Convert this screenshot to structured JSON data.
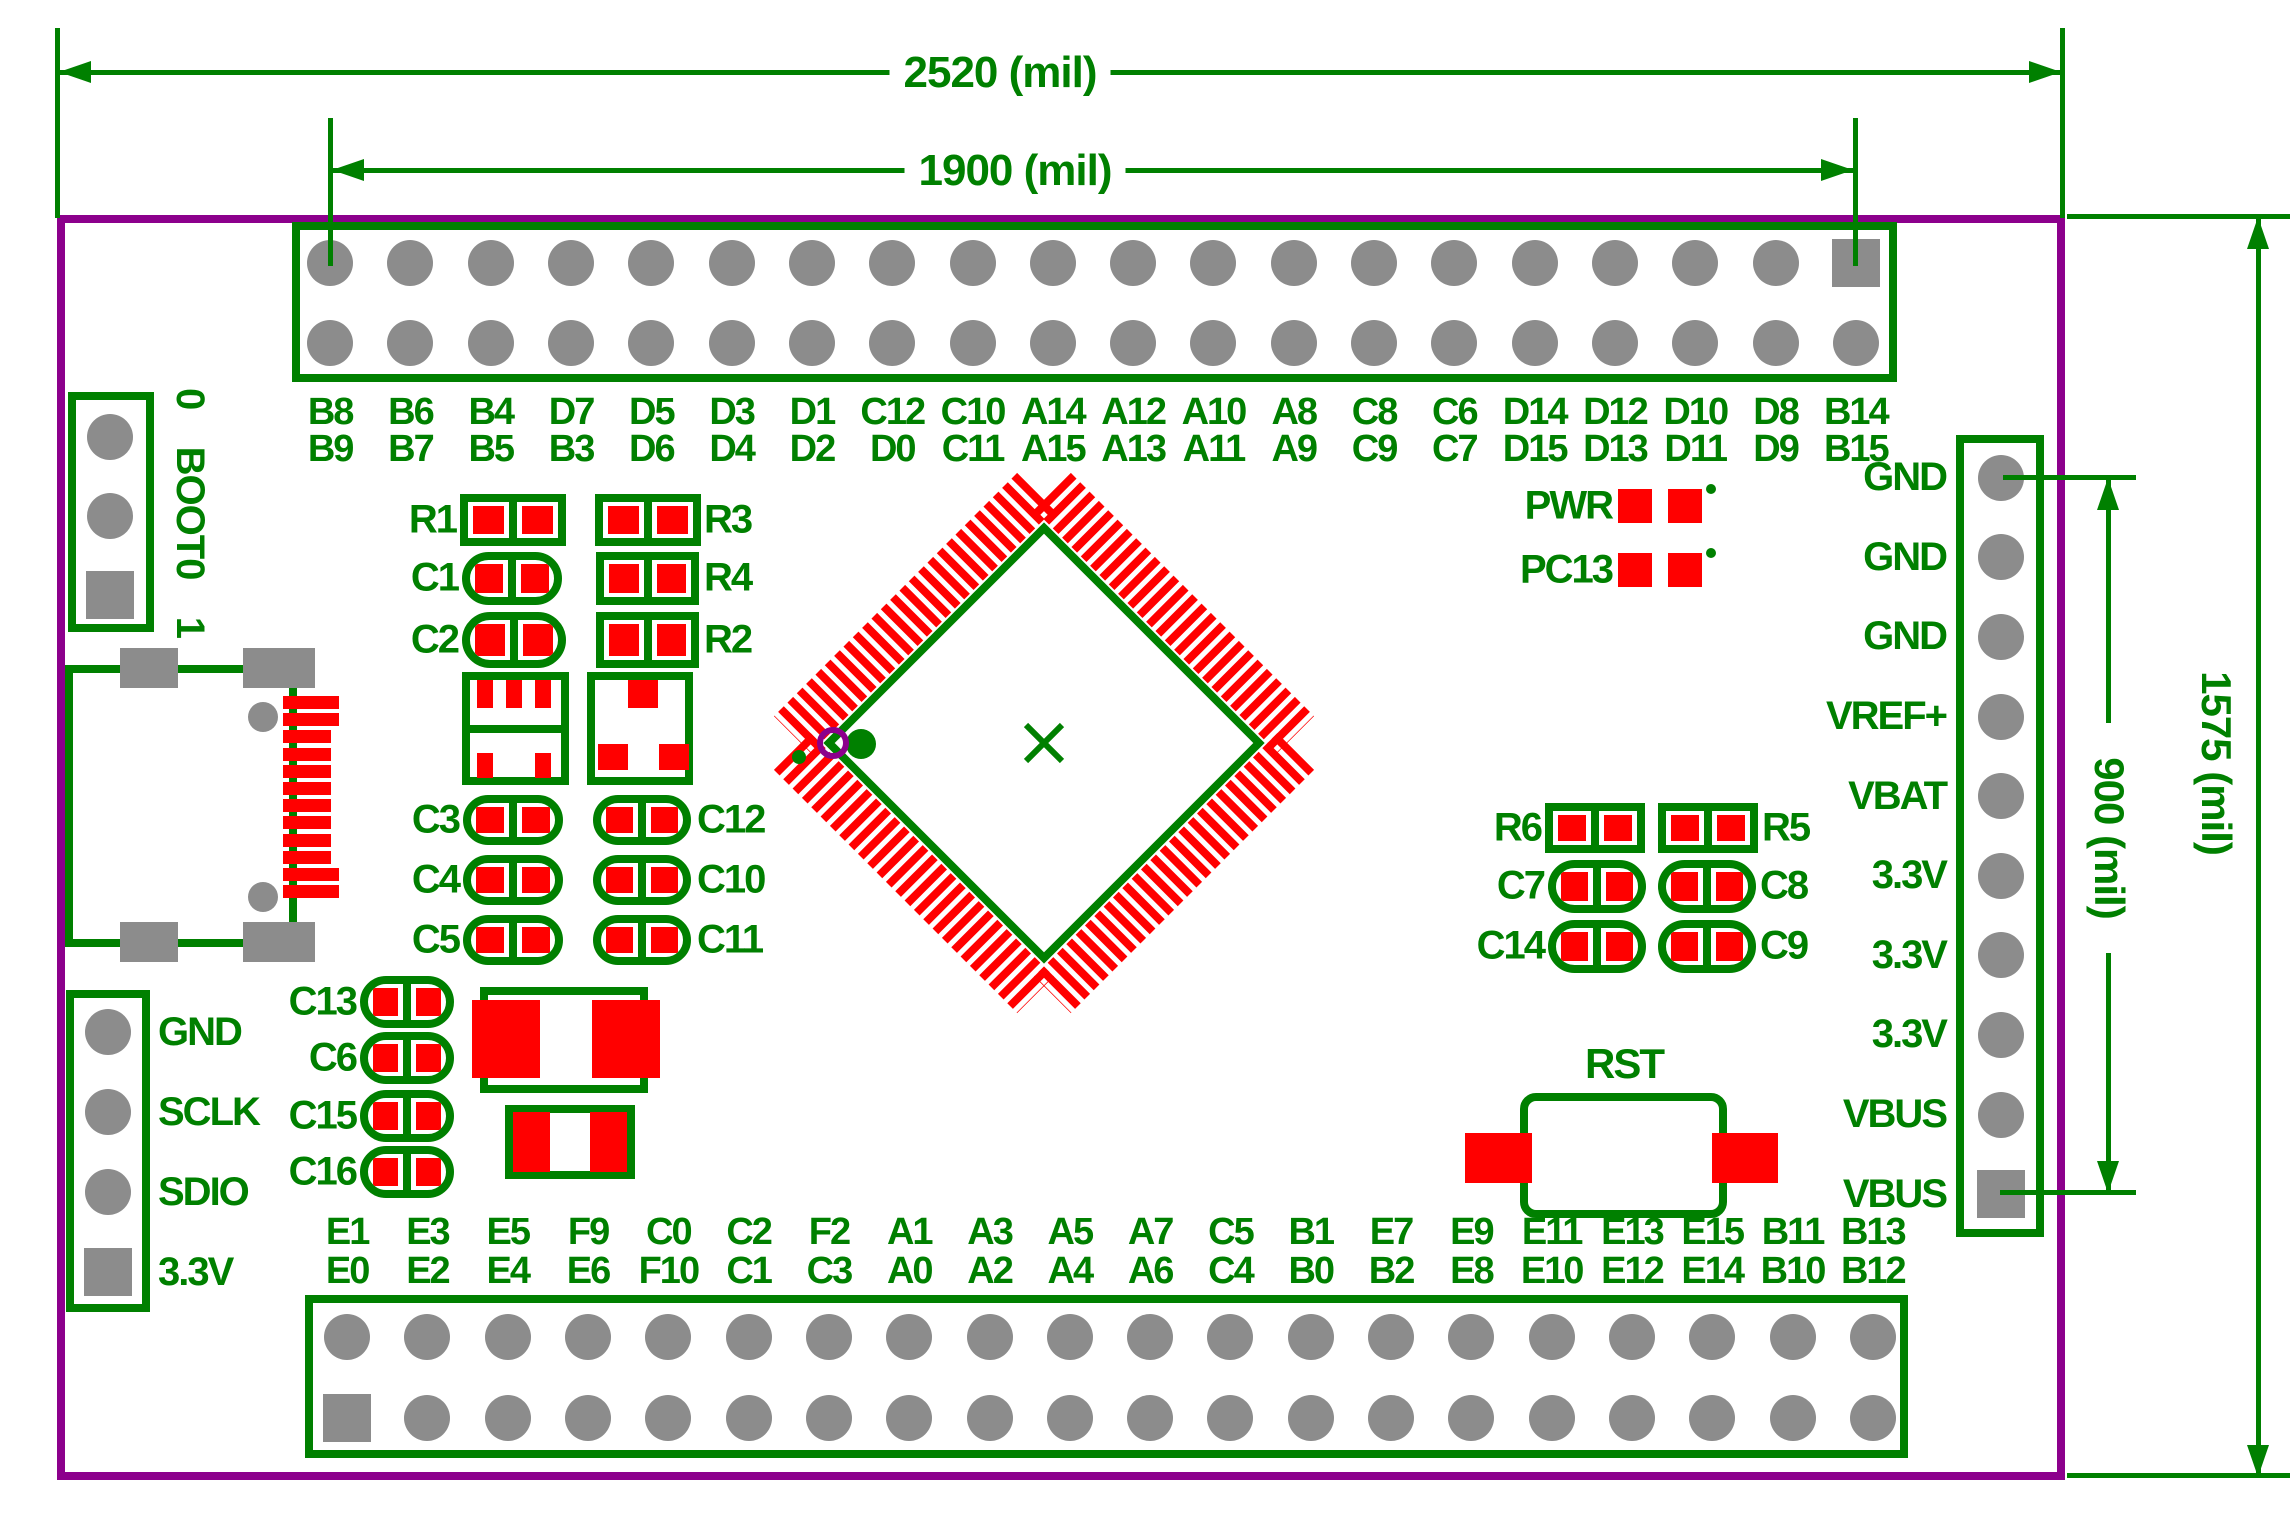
{
  "dimensions": {
    "top_outer": "2520 (mil)",
    "top_inner": "1900 (mil)",
    "right_outer": "1575 (mil)",
    "right_inner": "900 (mil)"
  },
  "top_header": {
    "row1": [
      "B8",
      "B6",
      "B4",
      "D7",
      "D5",
      "D3",
      "D1",
      "C12",
      "C10",
      "A14",
      "A12",
      "A10",
      "A8",
      "C8",
      "C6",
      "D14",
      "D12",
      "D10",
      "D8",
      "B14"
    ],
    "row2": [
      "B9",
      "B7",
      "B5",
      "B3",
      "D6",
      "D4",
      "D2",
      "D0",
      "C11",
      "A15",
      "A13",
      "A11",
      "A9",
      "C9",
      "C7",
      "D15",
      "D13",
      "D11",
      "D9",
      "B15"
    ]
  },
  "bottom_header": {
    "row1": [
      "E1",
      "E3",
      "E5",
      "F9",
      "C0",
      "C2",
      "F2",
      "A1",
      "A3",
      "A5",
      "A7",
      "C5",
      "B1",
      "E7",
      "E9",
      "E11",
      "E13",
      "E15",
      "B11",
      "B13"
    ],
    "row2": [
      "E0",
      "E2",
      "E4",
      "E6",
      "F10",
      "C1",
      "C3",
      "A0",
      "A2",
      "A4",
      "A6",
      "C4",
      "B0",
      "B2",
      "E8",
      "E10",
      "E12",
      "E14",
      "B10",
      "B12"
    ]
  },
  "right_header": {
    "labels": [
      "GND",
      "GND",
      "GND",
      "VREF+",
      "VBAT",
      "3.3V",
      "3.3V",
      "3.3V",
      "VBUS",
      "VBUS"
    ]
  },
  "debug_header": {
    "labels": [
      "GND",
      "SCLK",
      "SDIO",
      "3.3V"
    ]
  },
  "boot_jumper": {
    "zero": "0",
    "label": "BOOT0",
    "one": "1"
  },
  "components": {
    "r1": "R1",
    "r2": "R2",
    "r3": "R3",
    "r4": "R4",
    "r5": "R5",
    "r6": "R6",
    "c1": "C1",
    "c2": "C2",
    "c3": "C3",
    "c4": "C4",
    "c5": "C5",
    "c6": "C6",
    "c7": "C7",
    "c8": "C8",
    "c9": "C9",
    "c10": "C10",
    "c11": "C11",
    "c12": "C12",
    "c13": "C13",
    "c14": "C14",
    "c15": "C15",
    "c16": "C16"
  },
  "leds": [
    {
      "label": "PWR"
    },
    {
      "label": "PC13"
    }
  ],
  "reset_button": {
    "label": "RST"
  },
  "colors": {
    "silkscreen_green": "#008000",
    "pad_red": "#FF0000",
    "drill_gray": "#8C8C8C",
    "board_purple": "#8C008C"
  }
}
